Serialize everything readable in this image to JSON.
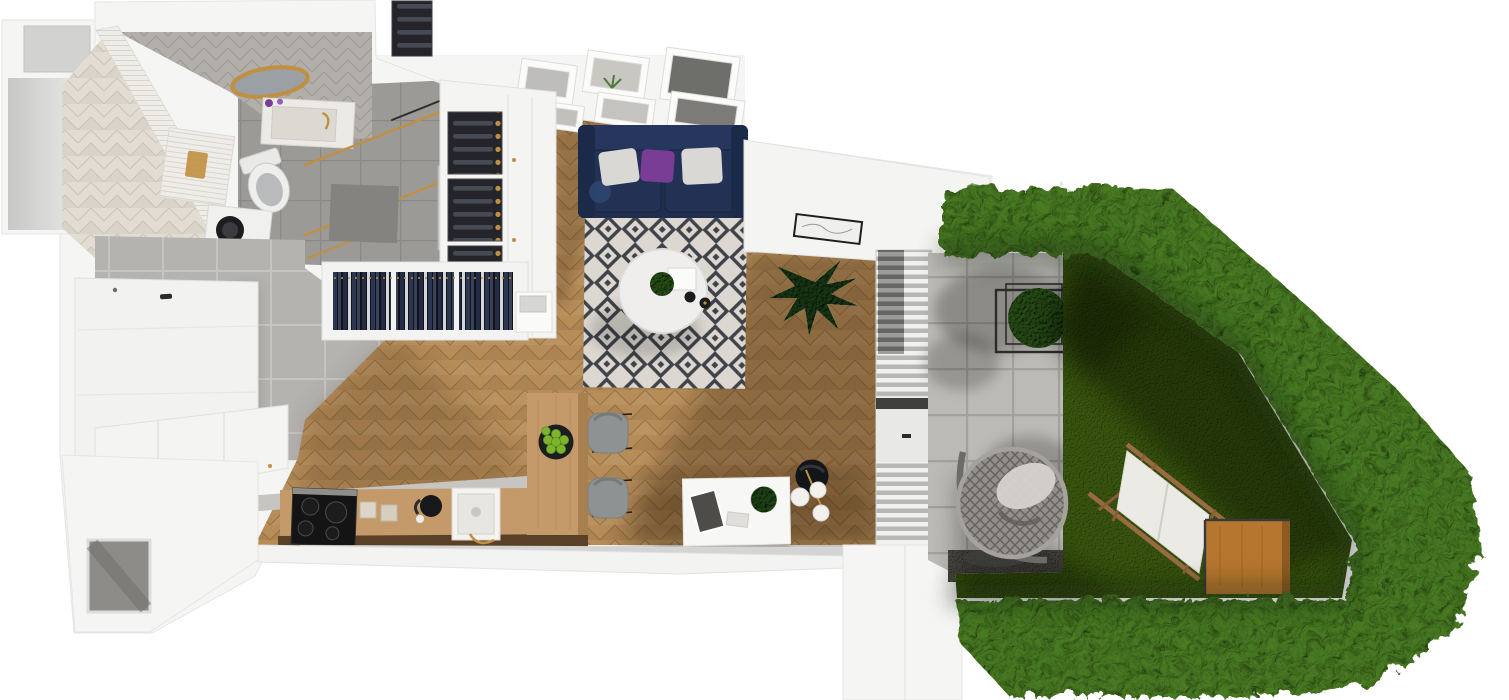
{
  "scene": {
    "kind": "3d-floor-plan-top-view-render",
    "interior_rooms": [
      {
        "name": "bathroom",
        "objects": [
          "herringbone-tile-floor",
          "subway-tile-wall",
          "gold-round-mirror",
          "stone-washbasin",
          "toilet",
          "washing-machine",
          "tiled-tub-deck",
          "walk-in-shower",
          "gold-towel-bars",
          "door"
        ]
      },
      {
        "name": "hallway",
        "objects": [
          "concrete-tile-floor",
          "white-wardrobe-panel",
          "open-wardrobe-hanging-clothes",
          "wine-rack",
          "white-cabinet-column"
        ]
      },
      {
        "name": "living-room",
        "objects": [
          "oak-herringbone-floor",
          "navy-sofa",
          "white-pillow",
          "purple-pillow",
          "diamond-pattern-rug",
          "round-coffee-table",
          "gallery-wall-six-frames",
          "monstera-plant",
          "wall-art-frame"
        ]
      },
      {
        "name": "kitchen",
        "objects": [
          "white-shaker-cabinets",
          "induction-cooktop",
          "farmhouse-sink",
          "gold-faucet",
          "kettle",
          "wood-breakfast-bar",
          "bowl-of-green-apples",
          "gray-chair",
          "gray-chair"
        ]
      },
      {
        "name": "workspace",
        "objects": [
          "white-desk",
          "desk-plant",
          "black-lounge-chair",
          "three-globe-floor-lamp"
        ]
      }
    ],
    "outdoor_areas": [
      {
        "name": "terrace",
        "objects": [
          "concrete-pavers",
          "rattan-egg-chair",
          "cube-trellis-with-climber",
          "vertical-louver-glazing",
          "gravel-strip",
          "tree-shadow"
        ]
      },
      {
        "name": "garden",
        "objects": [
          "lawn",
          "white-sun-lounger",
          "wood-cube-table",
          "clipped-hedge-boundary"
        ]
      }
    ]
  },
  "palette": {
    "bg": "#ffffff",
    "wall": "#f5f5f3",
    "wallEdge": "#e2e1df",
    "woodBase": "#b68c58",
    "woodSeam": "#8f6a3c",
    "tileBeige": "#e2ddd2",
    "tileBeigeSeam": "#cbc4b5",
    "chevGray": "#b2afaa",
    "chevGraySeam": "#9a9691",
    "subway": "#efede9",
    "subwayLine": "#d8d4cd",
    "concrete": "#b5b3b0",
    "concreteLine": "#c7c5c2",
    "shower": "#9c9a97",
    "showerLine": "#8b8986",
    "terrace": "#bcbab6",
    "terraceLine": "#a3a19d",
    "rugBase": "#dcd8d1",
    "rugDark": "#3f4349",
    "sofa": "#1f2d4e",
    "sofaDark": "#182340",
    "pillowWhite": "#d9d8d5",
    "pillowPurple": "#7a3d96",
    "gold": "#c18f41",
    "grass": "#47631e",
    "hedge": "#5d8a3c",
    "black": "#17181a",
    "chairGray": "#8f9293",
    "furnWood": "#b5762f",
    "counterTop": "#c6c5c2",
    "doorGray": "#c9c7c4",
    "gravel": "#62605a",
    "artGray": "#8e8c88"
  }
}
